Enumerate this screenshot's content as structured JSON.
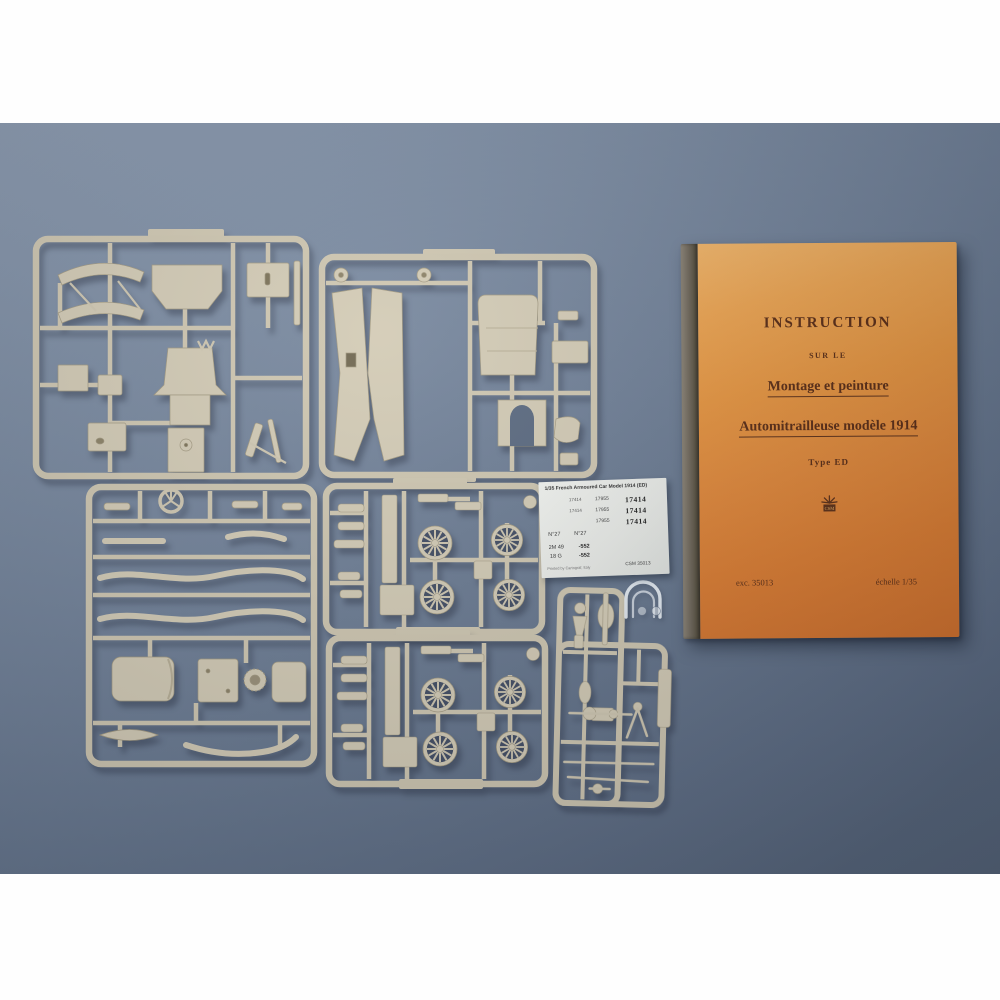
{
  "colors": {
    "background_top": "#8a99ae",
    "background_bottom": "#556377",
    "sprue_tan": "#d3cbb5",
    "sprue_edge": "#a39a81",
    "wheel_gap_dark": "#424d63",
    "booklet_orange": "#e18839",
    "booklet_spine": "#6e6659",
    "booklet_text": "#5a2c14",
    "decal_paper": "#eef0ec"
  },
  "booklet": {
    "title": "INSTRUCTION",
    "over_line": "SUR LE",
    "heading1": "Montage et peinture",
    "heading2": "Automitrailleuse modèle 1914",
    "type_line": "Type ED",
    "logo": "CSM",
    "ref_number": "exc. 35013",
    "scale": "échelle 1/35"
  },
  "decal_sheet": {
    "header": "1/35   French Armoured Car Model 1914 (ED)",
    "rows": [
      {
        "a": "17414",
        "b": "17955",
        "c": "17414"
      },
      {
        "a": "17414",
        "b": "17955",
        "c": "17414"
      },
      {
        "a": "",
        "b": "17955",
        "c": "17414"
      }
    ],
    "stencil_left": "N°27",
    "stencil_right": "N°27",
    "code_rows": [
      {
        "l": "2M 49",
        "r": "-552"
      },
      {
        "l": "18 G",
        "r": "-552"
      }
    ],
    "printer": "Printed by Cartograf, Italy",
    "sheet_code": "CSM 35013"
  }
}
